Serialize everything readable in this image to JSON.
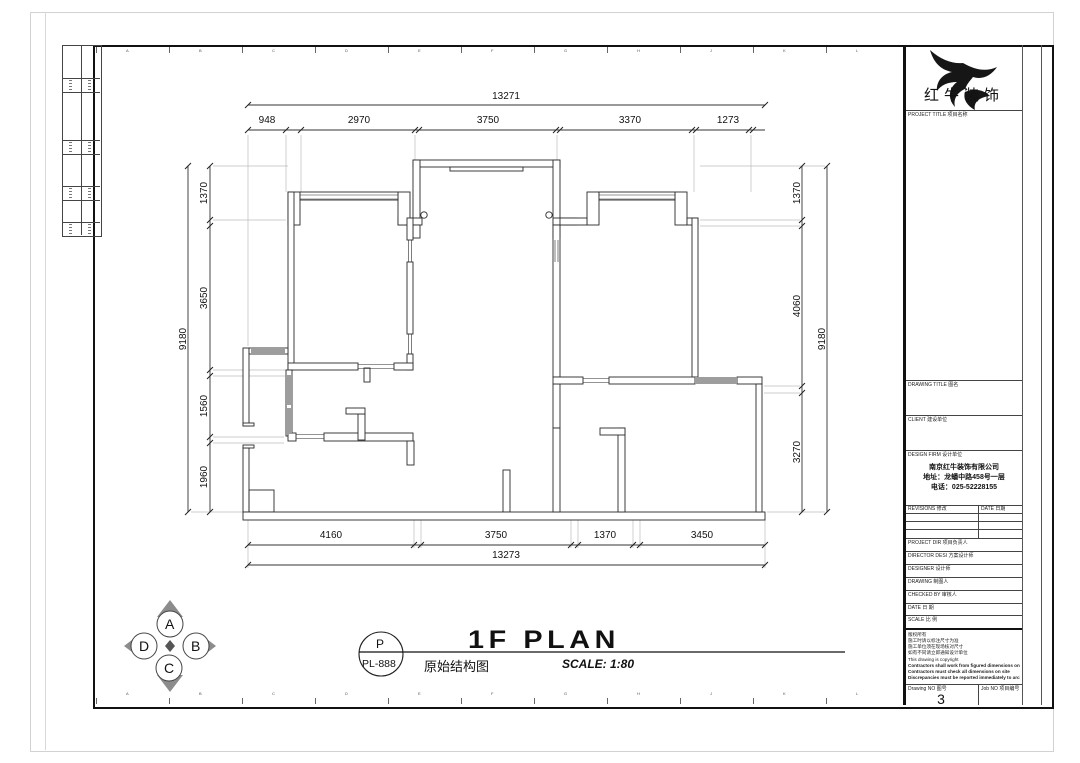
{
  "brand": {
    "name_cn": "红牛装饰"
  },
  "grid_letters": [
    "A",
    "B",
    "C",
    "D",
    "E",
    "F",
    "G",
    "H",
    "J",
    "K",
    "L"
  ],
  "plan": {
    "dims": {
      "top": {
        "overall": "13271",
        "segments": [
          "948",
          "2970",
          "3750",
          "3370",
          "1273"
        ]
      },
      "bottom": {
        "overall": "13273",
        "segments": [
          "4160",
          "3750",
          "1370",
          "3450"
        ]
      },
      "left": {
        "overall": "9180",
        "segments": [
          "1370",
          "3650",
          "1560",
          "1960"
        ]
      },
      "right": {
        "overall": "9180",
        "segments": [
          "1370",
          "4060",
          "3270"
        ]
      }
    }
  },
  "annotation": {
    "callout_top": "P",
    "callout_bottom": "PL-888",
    "title_en": "1F PLAN",
    "title_cn": "原始结构图",
    "scale": "SCALE: 1:80"
  },
  "compass": {
    "north": "A",
    "east": "B",
    "south": "C",
    "west": "D"
  },
  "titleblock": {
    "project_title_label": "PROJECT TITLE  项目名称",
    "drawing_title_label": "DRAWING TITLE  图名",
    "client_label": "CLIENT  建设单位",
    "design_firm_label": "DESIGN FIRM  设计单位",
    "company_name": "南京红牛装饰有限公司",
    "company_address": "地址：龙蟠中路458号一层",
    "company_phone": "电话：025-52228155",
    "revisions_label": "REVISIONS  修改",
    "revisions_date_label": "DATE  日期",
    "fields": [
      "PROJECT DIR  项目负责人",
      "DIRECTOR DESI  方案设计师",
      "DESIGNER  设计师",
      "DRAWING  制图人",
      "CHECKED BY  审核人",
      "DATE  日  期",
      "SCALE  比  例"
    ],
    "notes_cn": [
      "版权所有",
      "施工时请以标注尺寸为准",
      "施工单位须在现场核对尺寸",
      "如有不同请立即通知设计单位"
    ],
    "notes_en": [
      "This drawing is copyright",
      "Contractors shall work from figured dimensions only",
      "Contractors must check all dimensions on site",
      "Discrepancies must be reported immediately to architects"
    ],
    "drawing_no_label": "Drawing NO  图号",
    "drawing_no": "3",
    "job_no_label": "Job NO  项目编号"
  }
}
